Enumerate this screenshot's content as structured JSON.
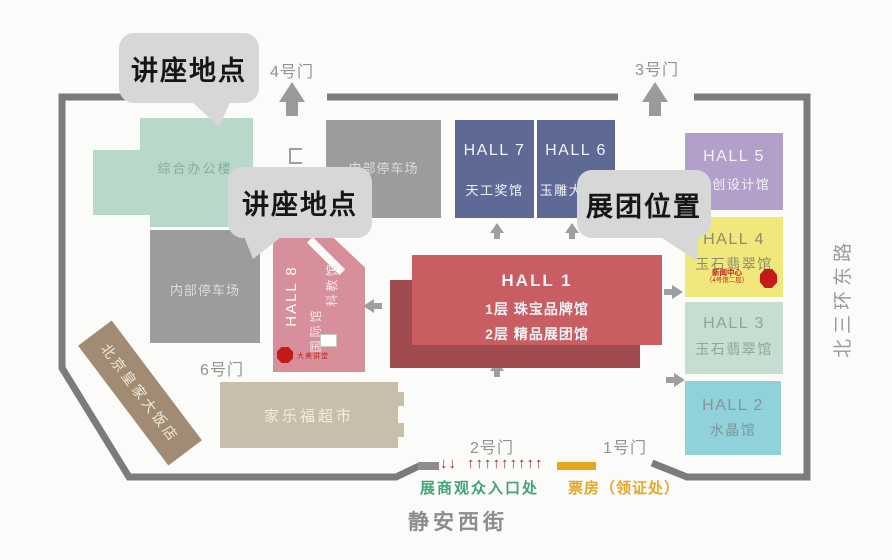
{
  "callouts": {
    "lecture_top": "讲座地点",
    "lecture_mid": "讲座地点",
    "exhibit": "展团位置"
  },
  "gates": {
    "g4": "4号门",
    "g3": "3号门",
    "g6": "6号门",
    "g2": "2号门",
    "g1": "1号门"
  },
  "halls": {
    "h7": {
      "name": "HALL 7",
      "desc": "天工奖馆"
    },
    "h6": {
      "name": "HALL 6",
      "desc": "玉雕大师馆"
    },
    "h5": {
      "name": "HALL 5",
      "desc": "文创设计馆"
    },
    "h4": {
      "name": "HALL 4",
      "desc": "玉石翡翠馆",
      "note1": "新闻中心",
      "note2": "（4号馆二层）"
    },
    "h3": {
      "name": "HALL 3",
      "desc": "玉石翡翠馆"
    },
    "h2": {
      "name": "HALL 2",
      "desc": "水晶馆"
    },
    "h1": {
      "name": "HALL 1",
      "desc1": "1层 珠宝品牌馆",
      "desc2": "2层 精品展团馆"
    },
    "h8": {
      "name": "HALL 8",
      "desc1": "国际馆",
      "desc2": "科教馆",
      "marker": "大美讲堂"
    }
  },
  "buildings": {
    "office": "综合办公楼",
    "parking_north": "内部停车场",
    "parking_west": "内部停车场",
    "supermarket": "家乐福超市",
    "hotel": "北京皇家大饭店"
  },
  "legend": {
    "entrance_label": "展商观众入口处",
    "ticket_label": "票房（领证处）",
    "arrows_down": "↓↓",
    "arrows_up": "↑↑↑↑↑↑↑↑↑"
  },
  "streets": {
    "south": "静安西街",
    "east": "北三环东路"
  },
  "colors": {
    "wall": "#7b7b7b",
    "office": "#b8d8c9",
    "parking": "#9c9c9c",
    "hall_blue": "#5e6996",
    "hall_purple": "#b2a0ca",
    "hall_yellow": "#f1e87c",
    "hall_pale_green": "#c6ddd0",
    "hall_cyan": "#90d1da",
    "hall_red": "#c85d62",
    "hall_red_shadow": "#a04b50",
    "hall_pink": "#d78f9b",
    "supermarket": "#c9beab",
    "hotel": "#a18b72",
    "bubble": "#d7d7d7",
    "marker_red": "#c31a1a",
    "entrance_green": "#43a477",
    "ticket_orange": "#e2a82c",
    "legend_red": "#a32636"
  }
}
